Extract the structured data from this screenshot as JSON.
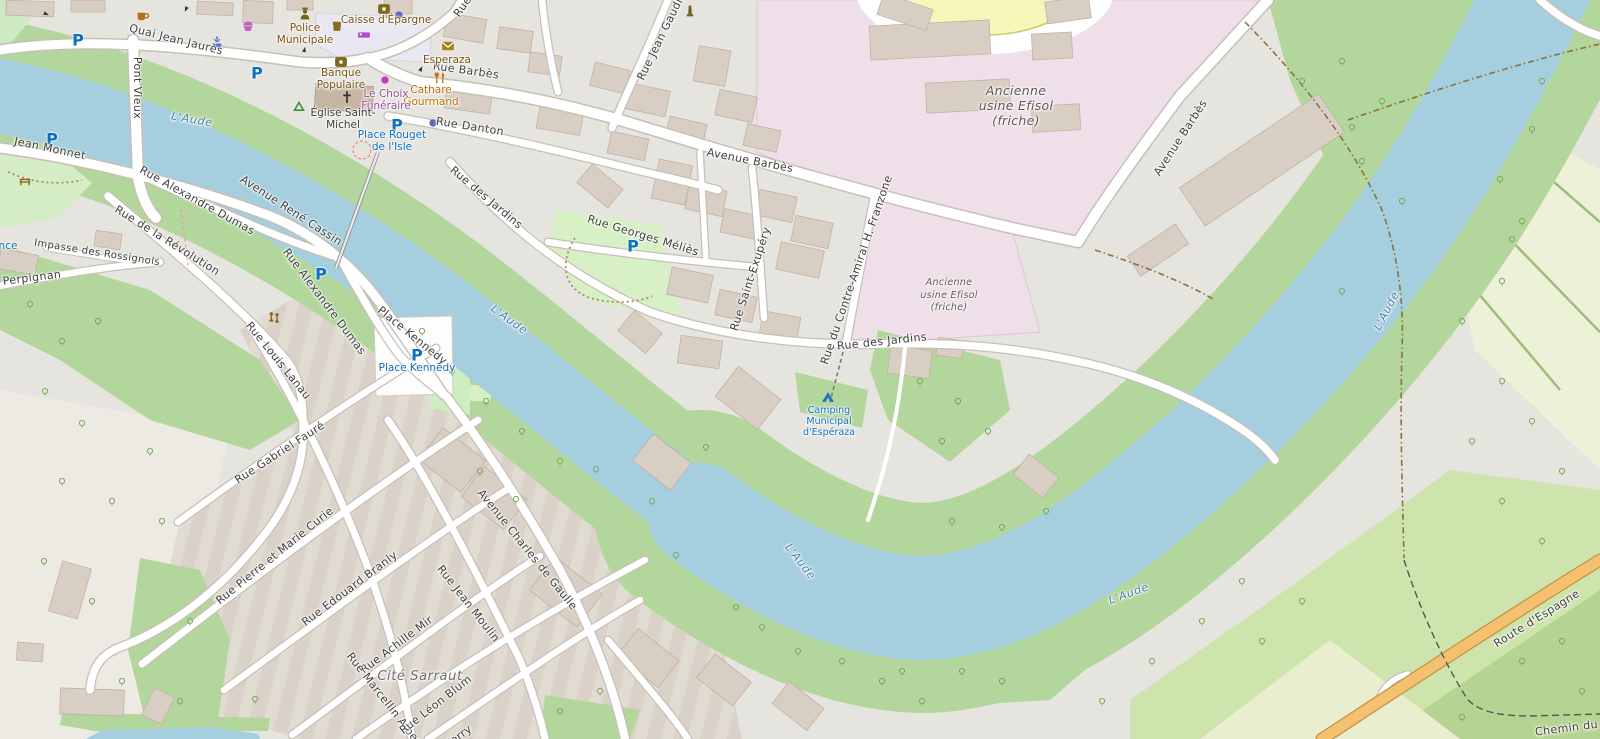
{
  "map": {
    "colors": {
      "land": "#e6e4df",
      "land_light": "#edeae3",
      "water": "#a5cede",
      "green_bank": "#b3d69c",
      "park": "#d7f0c6",
      "park_light": "#cfe9c2",
      "industrial_pink": "#efdfe9",
      "farmland": "#edf1d7",
      "meadow": "#cde4ad",
      "meadow_dark": "#b6d491",
      "meadow_pale": "#e9efce",
      "building": "#d8cec4",
      "building_outline": "#bfae9e",
      "church": "#c7b5a4",
      "road_fill": "#ffffff",
      "road_casing": "#c6c0b6",
      "road_primary": "#f4c170",
      "road_primary_casing": "#c89141",
      "pedestrian_area": "#e9e8f2",
      "pitch_yellow": "#f6f6b8",
      "label_street": "#3e3e3e",
      "label_water": "#4d80a4",
      "label_poi_brown": "#7a5413",
      "label_poi_blue": "#0d6fc2",
      "parking_blue": "#0d6fc2"
    },
    "labels": [
      {
        "text": "Quai Jean Jaurès",
        "x": 176,
        "y": 40,
        "rot": 14,
        "cls": "street",
        "size": 11
      },
      {
        "text": "Pont Vieux",
        "x": 137,
        "y": 88,
        "rot": 90,
        "cls": "street",
        "size": 11
      },
      {
        "text": "Jean Monnet",
        "x": 50,
        "y": 149,
        "rot": 12,
        "cls": "street",
        "size": 11
      },
      {
        "text": "Rue de Perpignan",
        "x": 10,
        "y": 281,
        "rot": -7,
        "cls": "street",
        "size": 11
      },
      {
        "text": "Impasse des Rossignols",
        "x": 97,
        "y": 253,
        "rot": 9,
        "cls": "street",
        "size": 10
      },
      {
        "text": "Rue de la Révolution",
        "x": 167,
        "y": 241,
        "rot": 32,
        "cls": "street",
        "size": 11
      },
      {
        "text": "Rue Alexandre Dumas",
        "x": 197,
        "y": 201,
        "rot": 29,
        "cls": "street",
        "size": 11
      },
      {
        "text": "Avenue René Cassin",
        "x": 291,
        "y": 211,
        "rot": 33,
        "cls": "street",
        "size": 11
      },
      {
        "text": "Rue Alexandre Dumas",
        "x": 324,
        "y": 302,
        "rot": 53,
        "cls": "street",
        "size": 11
      },
      {
        "text": "Rue Louis Lanau",
        "x": 278,
        "y": 361,
        "rot": 51,
        "cls": "street",
        "size": 11
      },
      {
        "text": "Place Kennedy",
        "x": 412,
        "y": 336,
        "rot": 39,
        "cls": "street",
        "size": 11
      },
      {
        "text": "Rue Gabriel Fauré",
        "x": 280,
        "y": 453,
        "rot": -33,
        "cls": "street",
        "size": 11
      },
      {
        "text": "Rue Pierre et Marie Curie",
        "x": 275,
        "y": 556,
        "rot": -39,
        "cls": "street",
        "size": 11
      },
      {
        "text": "Rue Edouard Branly",
        "x": 350,
        "y": 589,
        "rot": -37,
        "cls": "street",
        "size": 11
      },
      {
        "text": "Rue Achille Mir",
        "x": 397,
        "y": 645,
        "rot": -37,
        "cls": "street",
        "size": 11
      },
      {
        "text": "Rue Marcellin Albert",
        "x": 385,
        "y": 701,
        "rot": 52,
        "cls": "street",
        "size": 11
      },
      {
        "text": "Rue Léon Blum",
        "x": 436,
        "y": 705,
        "rot": -38,
        "cls": "street",
        "size": 11
      },
      {
        "text": "Ferry",
        "x": 459,
        "y": 737,
        "rot": -37,
        "cls": "street",
        "size": 11
      },
      {
        "text": "Rue Jean Moulin",
        "x": 468,
        "y": 604,
        "rot": 52,
        "cls": "street",
        "size": 11
      },
      {
        "text": "Avenue Charles de Gaulle",
        "x": 527,
        "y": 550,
        "rot": 51,
        "cls": "street",
        "size": 11
      },
      {
        "text": "Rue des Jardins",
        "x": 486,
        "y": 198,
        "rot": 40,
        "cls": "street",
        "size": 11
      },
      {
        "text": "Rue Georges Méliès",
        "x": 643,
        "y": 236,
        "rot": 17,
        "cls": "street",
        "size": 11
      },
      {
        "text": "Rue Saint-Exupéry",
        "x": 751,
        "y": 279,
        "rot": -72,
        "cls": "street",
        "size": 11
      },
      {
        "text": "Rue du Contre-Amiral H. Franzone",
        "x": 857,
        "y": 270,
        "rot": -71,
        "cls": "street",
        "size": 11
      },
      {
        "text": "Avenue Barbès",
        "x": 750,
        "y": 161,
        "rot": 11,
        "cls": "street",
        "size": 11
      },
      {
        "text": "Avenue Barbès",
        "x": 1181,
        "y": 138,
        "rot": -57,
        "cls": "street",
        "size": 11
      },
      {
        "text": "Rue des Jardins",
        "x": 882,
        "y": 342,
        "rot": -6,
        "cls": "street",
        "size": 11
      },
      {
        "text": "Rue Jean Gaudiss",
        "x": 663,
        "y": 34,
        "rot": -64,
        "cls": "street",
        "size": 11
      },
      {
        "text": "Rue",
        "x": 463,
        "y": 7,
        "rot": -55,
        "cls": "street",
        "size": 11
      },
      {
        "text": "Rue Barbès",
        "x": 466,
        "y": 71,
        "rot": 8,
        "cls": "street",
        "size": 11
      },
      {
        "text": "Rue Danton",
        "x": 470,
        "y": 127,
        "rot": 9,
        "cls": "street",
        "size": 11
      },
      {
        "text": "Route d'Espagne",
        "x": 1537,
        "y": 619,
        "rot": -32,
        "cls": "street",
        "size": 11
      },
      {
        "text": "Chemin du T",
        "x": 1572,
        "y": 728,
        "rot": -7,
        "cls": "street",
        "size": 11
      },
      {
        "text": "L'Aude",
        "x": 192,
        "y": 120,
        "rot": 10,
        "cls": "water",
        "size": 11
      },
      {
        "text": "L'Aude",
        "x": 509,
        "y": 320,
        "rot": 36,
        "cls": "water",
        "size": 11
      },
      {
        "text": "L'Aude",
        "x": 800,
        "y": 562,
        "rot": 52,
        "cls": "water",
        "size": 11
      },
      {
        "text": "L'Aude",
        "x": 1129,
        "y": 594,
        "rot": -20,
        "cls": "water",
        "size": 11
      },
      {
        "text": "L'Aude",
        "x": 1387,
        "y": 311,
        "rot": -62,
        "cls": "water",
        "size": 11
      },
      {
        "text": "Ancienne",
        "x": 1016,
        "y": 91,
        "rot": 0,
        "cls": "area",
        "size": 12.5
      },
      {
        "text": "usine Efisol",
        "x": 1016,
        "y": 106,
        "rot": 0,
        "cls": "area",
        "size": 12.5
      },
      {
        "text": "(friche)",
        "x": 1016,
        "y": 121,
        "rot": 0,
        "cls": "area",
        "size": 12.5
      },
      {
        "text": "Ancienne",
        "x": 949,
        "y": 283,
        "rot": 0,
        "cls": "area",
        "size": 9.5
      },
      {
        "text": "usine Efisol",
        "x": 949,
        "y": 296,
        "rot": 0,
        "cls": "area",
        "size": 9.5
      },
      {
        "text": "(friche)",
        "x": 949,
        "y": 308,
        "rot": 0,
        "cls": "area",
        "size": 9.5
      },
      {
        "text": "Police",
        "x": 305,
        "y": 29,
        "rot": 0,
        "cls": "poi-brown",
        "size": 10.5
      },
      {
        "text": "Municipale",
        "x": 305,
        "y": 41,
        "rot": 0,
        "cls": "poi-brown",
        "size": 10.5
      },
      {
        "text": "Caisse d'Épargne",
        "x": 386,
        "y": 21,
        "rot": 0,
        "cls": "poi-brown",
        "size": 10.5
      },
      {
        "text": "Banque",
        "x": 341,
        "y": 74,
        "rot": 0,
        "cls": "poi-brown",
        "size": 10.5
      },
      {
        "text": "Populaire",
        "x": 341,
        "y": 86,
        "rot": 0,
        "cls": "poi-brown",
        "size": 10.5
      },
      {
        "text": "Esperaza",
        "x": 447,
        "y": 61,
        "rot": 0,
        "cls": "poi-brown",
        "size": 10.5
      },
      {
        "text": "Cathare",
        "x": 431,
        "y": 91,
        "rot": 0,
        "cls": "poi-orange",
        "size": 10.5
      },
      {
        "text": "Gourmand",
        "x": 431,
        "y": 103,
        "rot": 0,
        "cls": "poi-orange",
        "size": 10.5
      },
      {
        "text": "Le Choix",
        "x": 386,
        "y": 95,
        "rot": 0,
        "cls": "poi-purple",
        "size": 10.5
      },
      {
        "text": "Funéraire",
        "x": 386,
        "y": 107,
        "rot": 0,
        "cls": "poi-purple",
        "size": 10.5
      },
      {
        "text": "Église Saint-",
        "x": 343,
        "y": 114,
        "rot": 0,
        "cls": "poi-dark",
        "size": 10.5
      },
      {
        "text": "Michel",
        "x": 343,
        "y": 126,
        "rot": 0,
        "cls": "poi-dark",
        "size": 10.5
      },
      {
        "text": "Place Rouget",
        "x": 392,
        "y": 136,
        "rot": 0,
        "cls": "poi-blue",
        "size": 10.5
      },
      {
        "text": "de l'Isle",
        "x": 392,
        "y": 148,
        "rot": 0,
        "cls": "poi-blue",
        "size": 10.5
      },
      {
        "text": "Place Kennedy",
        "x": 417,
        "y": 369,
        "rot": 0,
        "cls": "poi-blue",
        "size": 10.5
      },
      {
        "text": "Camping",
        "x": 829,
        "y": 411,
        "rot": 0,
        "cls": "poi-blue",
        "size": 9.5
      },
      {
        "text": "Municipal",
        "x": 829,
        "y": 422,
        "rot": 0,
        "cls": "poi-blue",
        "size": 9.5
      },
      {
        "text": "d'Espéraza",
        "x": 829,
        "y": 433,
        "rot": 0,
        "cls": "poi-blue",
        "size": 9.5
      },
      {
        "text": "nce",
        "x": 8,
        "y": 247,
        "rot": 0,
        "cls": "poi-blue",
        "size": 10.5
      },
      {
        "text": "Cité Sarraut",
        "x": 420,
        "y": 677,
        "rot": 0,
        "cls": "place",
        "size": 13
      }
    ],
    "icons": [
      {
        "glyph": "parking",
        "x": 78,
        "y": 40,
        "color": "#0d6fc2",
        "rot": 0
      },
      {
        "glyph": "parking",
        "x": 257,
        "y": 73,
        "color": "#0d6fc2",
        "rot": 0
      },
      {
        "glyph": "parking",
        "x": 52,
        "y": 139,
        "color": "#0d6fc2",
        "rot": 0
      },
      {
        "glyph": "parking",
        "x": 397,
        "y": 125,
        "color": "#0d6fc2",
        "rot": 0
      },
      {
        "glyph": "parking",
        "x": 633,
        "y": 246,
        "color": "#0d6fc2",
        "rot": 0
      },
      {
        "glyph": "parking",
        "x": 321,
        "y": 274,
        "color": "#0d6fc2",
        "rot": 0
      },
      {
        "glyph": "parking",
        "x": 417,
        "y": 355,
        "color": "#0d6fc2",
        "rot": 0
      },
      {
        "glyph": "cup",
        "x": 143,
        "y": 16,
        "color": "#b06f1f",
        "rot": 0
      },
      {
        "glyph": "cupcake",
        "x": 248,
        "y": 25,
        "color": "#c45fc4",
        "rot": 0
      },
      {
        "glyph": "police",
        "x": 305,
        "y": 14,
        "color": "#70621c",
        "rot": 0
      },
      {
        "glyph": "drink",
        "x": 337,
        "y": 26,
        "color": "#8a6d1a",
        "rot": 0
      },
      {
        "glyph": "hotel",
        "x": 364,
        "y": 35,
        "color": "#ad4fc0",
        "rot": 0
      },
      {
        "glyph": "bank",
        "x": 341,
        "y": 62,
        "color": "#7c6a1a",
        "rot": 0
      },
      {
        "glyph": "bank",
        "x": 384,
        "y": 9,
        "color": "#7c6a1a",
        "rot": 0
      },
      {
        "glyph": "dot",
        "x": 399,
        "y": 15,
        "color": "#5a6abe",
        "rot": 0
      },
      {
        "glyph": "dot",
        "x": 385,
        "y": 80,
        "color": "#c23ac2",
        "rot": 0
      },
      {
        "glyph": "dot",
        "x": 433,
        "y": 123,
        "color": "#5a6abe",
        "rot": 0
      },
      {
        "glyph": "envelope",
        "x": 448,
        "y": 46,
        "color": "#a8821a",
        "rot": 0
      },
      {
        "glyph": "restaurant",
        "x": 440,
        "y": 78,
        "color": "#c77400",
        "rot": 0
      },
      {
        "glyph": "cross",
        "x": 347,
        "y": 97,
        "color": "#333333",
        "rot": 0
      },
      {
        "glyph": "recycle",
        "x": 299,
        "y": 107,
        "color": "#3f8f3f",
        "rot": 0
      },
      {
        "glyph": "fountain",
        "x": 217,
        "y": 42,
        "color": "#4a6fc8",
        "rot": 0
      },
      {
        "glyph": "bench",
        "x": 25,
        "y": 181,
        "color": "#8a6d1a",
        "rot": 0
      },
      {
        "glyph": "memorial",
        "x": 690,
        "y": 11,
        "color": "#70621c",
        "rot": 0
      },
      {
        "glyph": "playground",
        "x": 274,
        "y": 317,
        "color": "#8a6d1a",
        "rot": 0
      },
      {
        "glyph": "tent",
        "x": 828,
        "y": 397,
        "color": "#2a6fbe",
        "rot": 0
      },
      {
        "glyph": "arrow",
        "x": 44,
        "y": 13,
        "color": "#333333",
        "rot": 25
      },
      {
        "glyph": "arrow",
        "x": 187,
        "y": 7,
        "color": "#333333",
        "rot": 115
      },
      {
        "glyph": "arrow",
        "x": 304,
        "y": 52,
        "color": "#333333",
        "rot": -78
      },
      {
        "glyph": "arrow",
        "x": 420,
        "y": 71,
        "color": "#333333",
        "rot": -65
      }
    ]
  }
}
